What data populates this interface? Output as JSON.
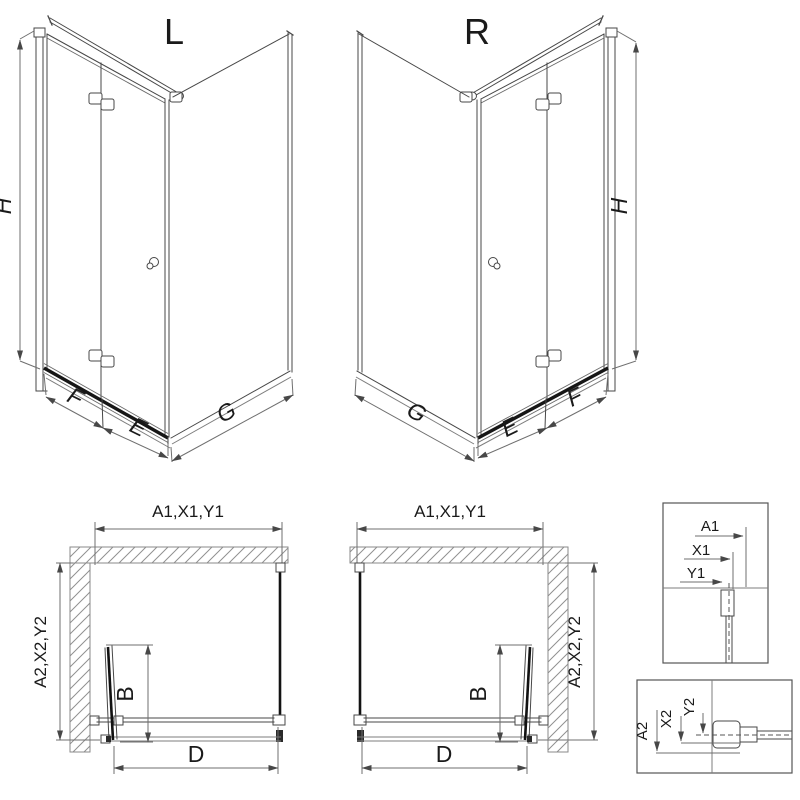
{
  "drawing": {
    "perspective_left": {
      "title": "L",
      "dim_height": "H",
      "dim_fixed": "F",
      "dim_door": "E",
      "dim_side": "G"
    },
    "perspective_right": {
      "title": "R",
      "dim_height": "H",
      "dim_fixed": "F",
      "dim_door": "E",
      "dim_side": "G"
    },
    "plan_left": {
      "dim_width": "A1,X1,Y1",
      "dim_depth": "A2,X2,Y2",
      "dim_door_depth": "B",
      "dim_opening": "D"
    },
    "plan_right": {
      "dim_width": "A1,X1,Y1",
      "dim_depth": "A2,X2,Y2",
      "dim_door_depth": "B",
      "dim_opening": "D"
    },
    "detail_width": {
      "dim_outer": "A1",
      "dim_mid": "X1",
      "dim_inner": "Y1"
    },
    "detail_depth": {
      "dim_outer": "A2",
      "dim_mid": "X2",
      "dim_inner": "Y2"
    }
  },
  "colors": {
    "background": "#ffffff",
    "line": "#474747",
    "dark": "#161616",
    "dim": "#6f6f6f",
    "hatch": "#909090",
    "text": "#1a1a1a"
  }
}
